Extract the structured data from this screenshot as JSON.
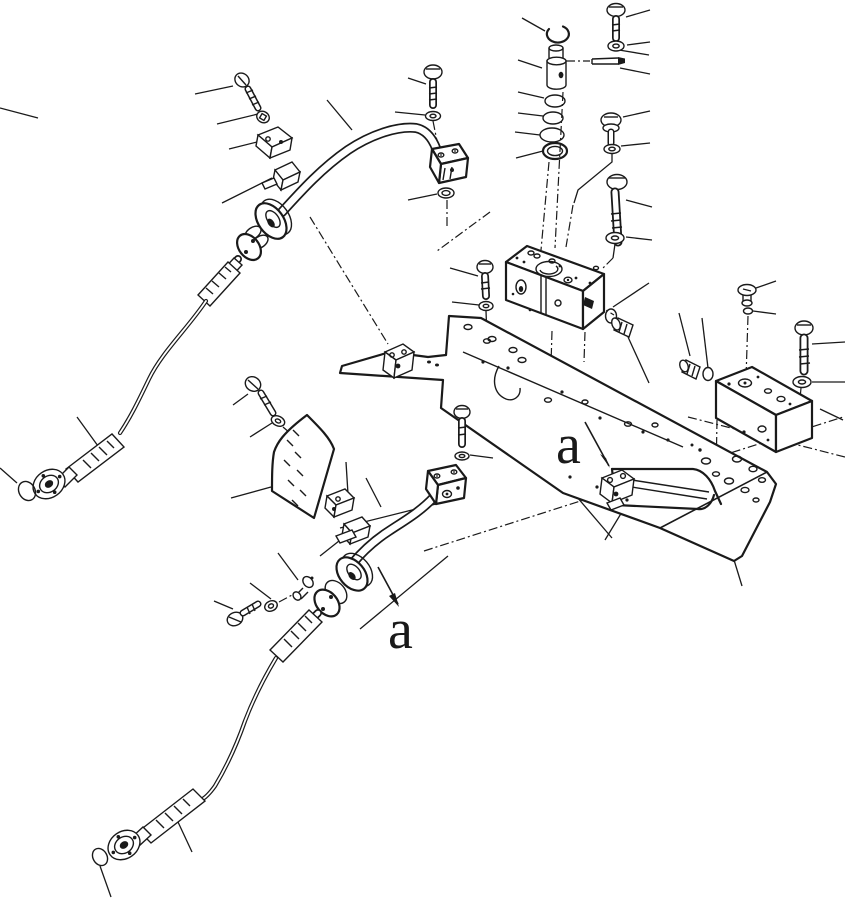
{
  "page": {
    "background": "#ffffff",
    "ink": "#1a1a1a"
  },
  "figure": {
    "type": "exploded-parts-diagram",
    "labels": {
      "view_arrow_1": "a",
      "view_arrow_2": "a"
    },
    "parts": [
      "hex-bolt",
      "plain-washer",
      "o-ring",
      "snap-ring",
      "valve-cartridge",
      "spring-pin",
      "pipe-clamp-half",
      "steel-pipe",
      "flanged-elbow",
      "hydraulic-hose",
      "hose-flange",
      "manifold-block",
      "hex-plug",
      "countersunk-plug",
      "guard-plate",
      "frame-crossmember",
      "support-bracket",
      "mounting-block"
    ]
  }
}
